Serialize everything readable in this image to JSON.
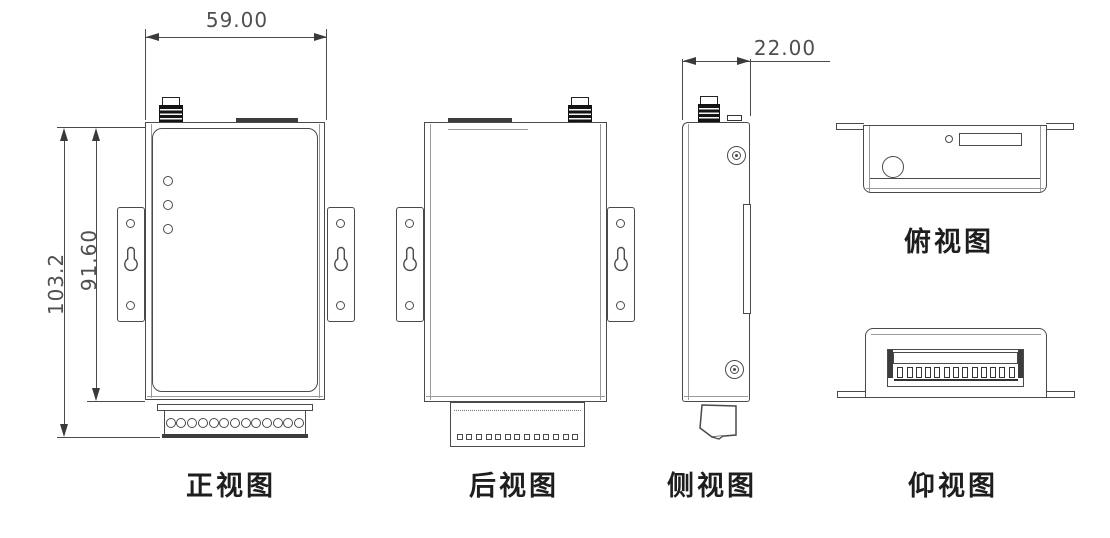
{
  "drawing": {
    "views": {
      "front": {
        "label": "正视图",
        "led_count": 3,
        "terminal_pins": 13
      },
      "rear": {
        "label": "后视图",
        "terminal_squares": 13
      },
      "side": {
        "label": "侧视图"
      },
      "top": {
        "label": "俯视图"
      },
      "bottom": {
        "label": "仰视图",
        "terminal_teeth": 13
      }
    },
    "dimensions": {
      "body_width": "59.00",
      "depth": "22.00",
      "total_height": "103.2",
      "body_height": "91.60"
    },
    "colors": {
      "line": "#4a4a4a",
      "line_light": "#9a9a9a",
      "dark": "#2a2a2a",
      "background": "#ffffff"
    }
  }
}
